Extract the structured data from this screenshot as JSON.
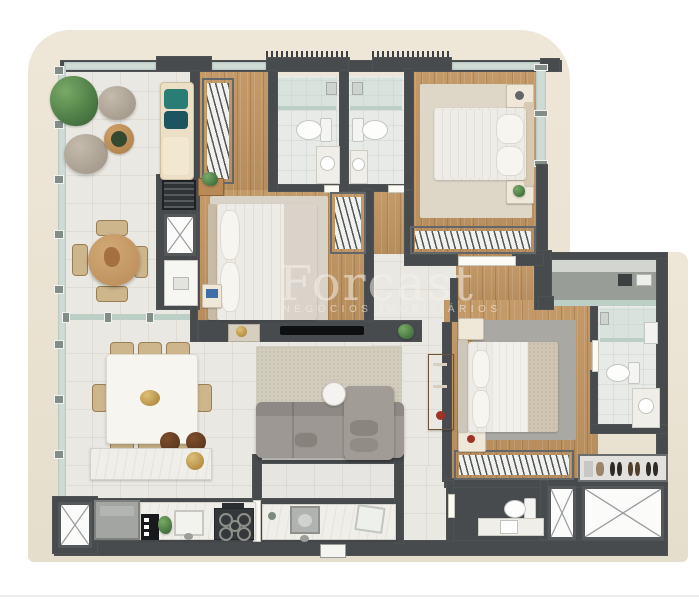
{
  "watermark": {
    "brand": "Forcast",
    "tagline": "NEGÓCIOS IMOBILIÁRIOS"
  },
  "palette": {
    "page_bg": "#ffffff",
    "shell": "#ebe4d4",
    "wall": "#474b4d",
    "tile": "#eae8e2",
    "wood": "#bd9463",
    "bath": "#e8eae7",
    "glass": "#cfdcd6",
    "glass_dark": "#bccfc7",
    "rug_beige": "#d8d3c6",
    "rug_gray": "#a9a8a3",
    "sofa_gray": "#9e9894",
    "furn_cream": "#ecdfc6",
    "teal_accent": "#2a7d74",
    "plant_green": "#4e7d46",
    "wood_furniture": "#c59a66",
    "gold_accent": "#c09a4e",
    "marble": "#efeee9",
    "appliance_dark": "#34383a"
  }
}
